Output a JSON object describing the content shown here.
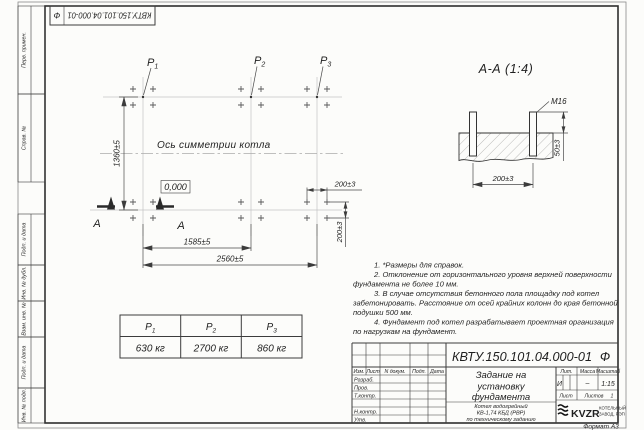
{
  "doc_number": "КВТУ.150.101.04.000-01",
  "doc_suffix": "Ф",
  "sidebar": {
    "items": [
      "Перв. примен.",
      "Справ. №",
      "Подп. и дата",
      "Инв. № дубл.",
      "Взам. инв. №",
      "Подп. и дата",
      "Инв. № подл."
    ]
  },
  "plan": {
    "axis_label": "Ось симметрии котла",
    "elevation_mark": "0,000",
    "section_letter": "А",
    "dims": {
      "height": "1360±5",
      "span_p1_p2": "1585±5",
      "span_total": "2560±5",
      "bolt_spacing_x": "200±3",
      "bolt_spacing_y": "200±3"
    }
  },
  "loads": [
    {
      "base": "Р",
      "sub": "1",
      "value": "630 кг"
    },
    {
      "base": "Р",
      "sub": "2",
      "value": "2700 кг"
    },
    {
      "base": "Р",
      "sub": "3",
      "value": "860 кг"
    }
  ],
  "section_view": {
    "title": "А-А (1:4)",
    "bolt_label": "М16",
    "dim_protrusion": "50±3",
    "dim_spacing": "200±3"
  },
  "notes": [
    "1. *Размеры для справок.",
    "2. Отклонение от горизонтального уровня верхней поверхности",
    "фундамента не более 10 мм.",
    "3. В случае отсутствия бетонного пола площадку под котел",
    "забетонировать. Расстояние от осей крайних колонн до края бетонной",
    "подушки 500 мм.",
    "4. Фундамент под котел разрабатывает проектная организация",
    "по нагрузкам на фундамент."
  ],
  "title_block": {
    "title_lines": [
      "Задание на",
      "установку",
      "фундамента"
    ],
    "subtitle_lines": [
      "Котел водогрейный",
      "КВ-1,74 КБД (РВР)",
      "по техническому заданию"
    ],
    "header_cells": [
      "Изм.",
      "Лист",
      "N докум.",
      "Подп.",
      "Дата"
    ],
    "staff_labels": [
      "Разраб.",
      "Пров.",
      "Т.контр.",
      "Н.контр.",
      "Утв."
    ],
    "lit_label": "Лит.",
    "mass_label": "Масса",
    "scale_label": "Масштаб",
    "lit_value": "И",
    "mass_value": "–",
    "scale_value": "1:15",
    "sheet_label": "Лист",
    "sheets_label": "Листов",
    "sheets_value": "1",
    "logo_text": "KVZR",
    "company_lines": [
      "КОТЕЛЬНЫЙ",
      "ЗАВОД, РЭП"
    ],
    "format_label": "Формат А3"
  }
}
